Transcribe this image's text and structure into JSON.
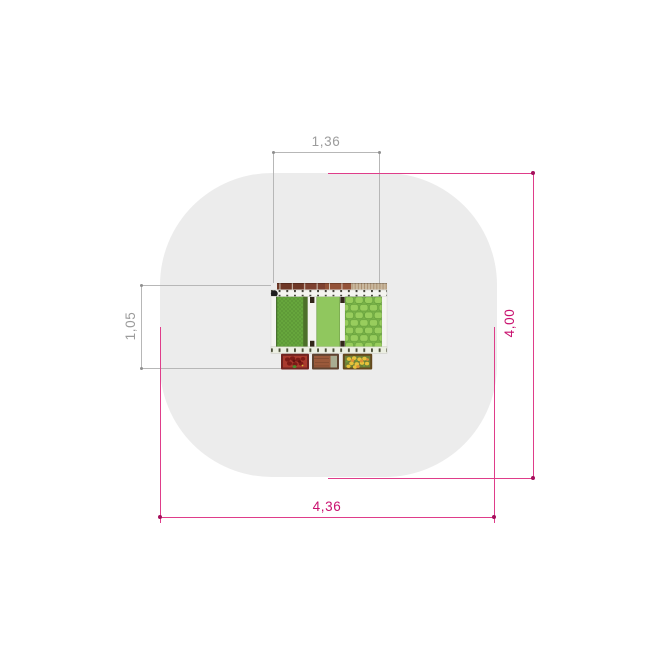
{
  "dimensions": {
    "item_width": {
      "label": "1,36"
    },
    "item_depth": {
      "label": "1,05"
    },
    "zone_width": {
      "label": "4,36"
    },
    "zone_height": {
      "label": "4,00"
    }
  },
  "colors": {
    "zone-fill": "#ececec",
    "dim-gray": "#b7b7b7",
    "dim-gray-text": "#9c9c9c",
    "gray-dot": "#8f8f8f",
    "pink-line": "#df3d8a",
    "pink-dot": "#a50f5c",
    "pink-text": "#c9116f",
    "plank-mid": "#8a4a33",
    "plank-light": "#c9b89e",
    "rail": "#f4f4ef",
    "tick": "#3e3e33",
    "post": "#32271a",
    "green-left": "#67a83d",
    "green-left-dark": "#4c7029",
    "green-mid": "#90c75e",
    "green-right-base": "#79b248",
    "green-cell": "#98cd5d",
    "green-cell-line": "#5f9a37",
    "box-red-frame": "#6f2420",
    "box-red-fill": "#a93a2e",
    "box-soil-frame": "#5f4330",
    "box-soil-fill": "#9a593a",
    "box-soil-gray": "#a9ad92",
    "box-yellow-frame": "#63481e",
    "box-yellow-fill": "#6e7f37",
    "flower-yellow": "#e5c23b",
    "flower-orange": "#dd9336",
    "flower-green": "#6f9c3c"
  }
}
